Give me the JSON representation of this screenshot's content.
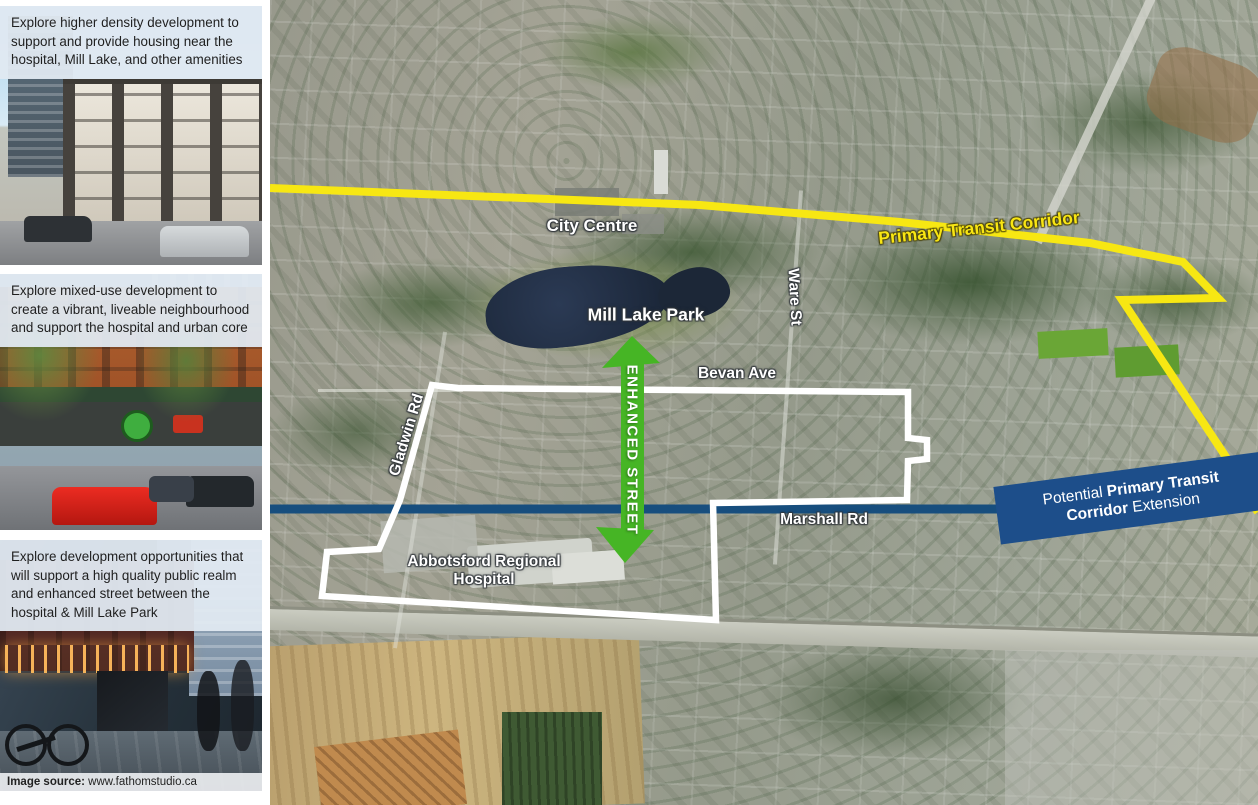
{
  "sidebar": {
    "cards": [
      {
        "text": "Explore higher density development to support and provide housing near the hospital, Mill Lake, and other amenities",
        "photo": "apartment-buildings"
      },
      {
        "text": "Explore mixed-use development to create a vibrant, liveable neighbourhood and support the hospital and urban core",
        "photo": "mixed-use-street"
      },
      {
        "text": "Explore development opportunities that will support a high quality public realm and enhanced street between the hospital & Mill Lake Park",
        "photo": "evening-street"
      }
    ],
    "image_source": {
      "label": "Image source:",
      "value": " www.fathomstudio.ca"
    }
  },
  "map": {
    "labels": {
      "city_centre": "City Centre",
      "mill_lake_park": "Mill Lake Park",
      "ware_st": "Ware St",
      "bevan_ave": "Bevan Ave",
      "gladwin_rd": "Gladwin Rd",
      "marshall_rd": "Marshall Rd",
      "hospital": "Abbotsford Regional\nHospital",
      "enhanced_street": "ENHANCED STREET",
      "primary_transit_corridor": "Primary Transit Corridor",
      "banner": {
        "line1_regular": "Potential ",
        "line1_bold": "Primary Transit",
        "line2_bold": "Corridor",
        "line2_regular": " Extension"
      }
    },
    "colors": {
      "transit_corridor_yellow": "#f7e713",
      "transit_extension_blue": "#174e7e",
      "banner_blue": "#1d4e8a",
      "enhanced_street_green": "#46b525",
      "boundary_white": "#ffffff"
    }
  }
}
